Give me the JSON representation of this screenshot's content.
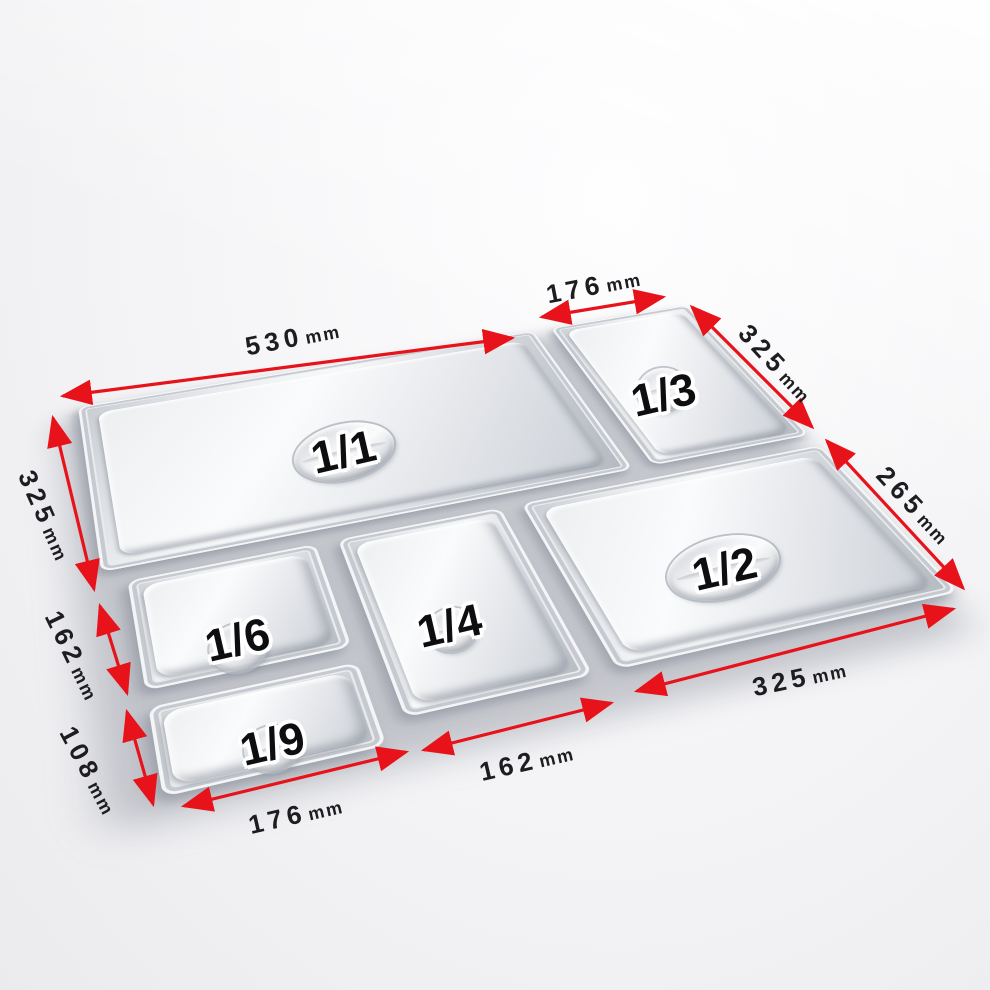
{
  "image": {
    "description": "Set of six stainless steel gastronorm pan lids shown in perspective with red dimension arrows",
    "background_color": "#f3f3f5"
  },
  "colors": {
    "dimension_red": "#e8121a",
    "label_black": "#1d1d21",
    "metal_light": "#f8f9fa",
    "metal_dark": "#b3b8c0"
  },
  "pans": [
    {
      "id": "1-1",
      "label": "1/1"
    },
    {
      "id": "1-3",
      "label": "1/3"
    },
    {
      "id": "1-2",
      "label": "1/2"
    },
    {
      "id": "1-6",
      "label": "1/6"
    },
    {
      "id": "1-4",
      "label": "1/4"
    },
    {
      "id": "1-9",
      "label": "1/9"
    }
  ],
  "dimensions": [
    {
      "pan": "1/1",
      "edge": "top",
      "value": "530",
      "unit": "mm"
    },
    {
      "pan": "1/3",
      "edge": "top",
      "value": "176",
      "unit": "mm"
    },
    {
      "pan": "1/3",
      "edge": "right",
      "value": "325",
      "unit": "mm"
    },
    {
      "pan": "1/2",
      "edge": "right",
      "value": "265",
      "unit": "mm"
    },
    {
      "pan": "1/1",
      "edge": "left",
      "value": "325",
      "unit": "mm"
    },
    {
      "pan": "1/6",
      "edge": "left",
      "value": "162",
      "unit": "mm"
    },
    {
      "pan": "1/9",
      "edge": "left",
      "value": "108",
      "unit": "mm"
    },
    {
      "pan": "1/9",
      "edge": "bottom",
      "value": "176",
      "unit": "mm"
    },
    {
      "pan": "1/4",
      "edge": "bottom",
      "value": "162",
      "unit": "mm"
    },
    {
      "pan": "1/2",
      "edge": "bottom",
      "value": "325",
      "unit": "mm"
    }
  ]
}
